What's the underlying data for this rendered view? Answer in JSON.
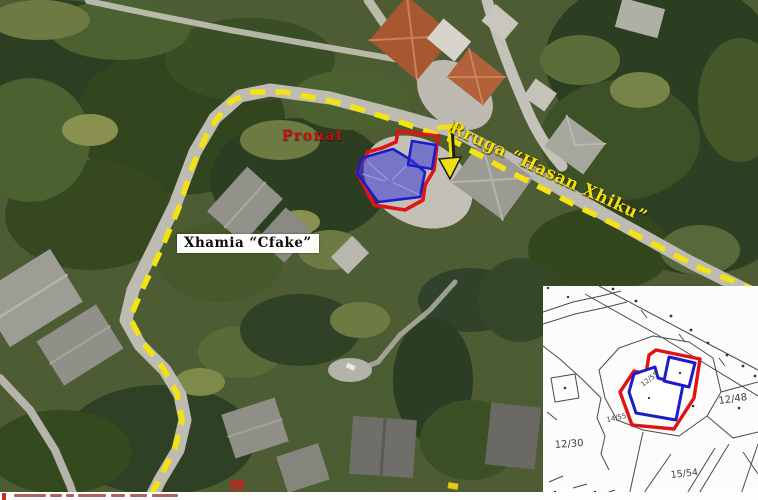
{
  "annotations": {
    "property_label": "Pronat",
    "street_label": "Rruga “Hasan Xhiku”",
    "mosque_label": "Xhamia “Cfake”"
  },
  "inset_map": {
    "parcels": [
      {
        "id": "12/48"
      },
      {
        "id": "12/30"
      },
      {
        "id": "15/54"
      },
      {
        "id": "12/55"
      },
      {
        "id": "14/55"
      }
    ]
  },
  "colors": {
    "route_yellow": "#f5e311",
    "highlight_red": "#e11414",
    "highlight_blue": "#1c1ccb",
    "label_red": "#c40f0f"
  }
}
